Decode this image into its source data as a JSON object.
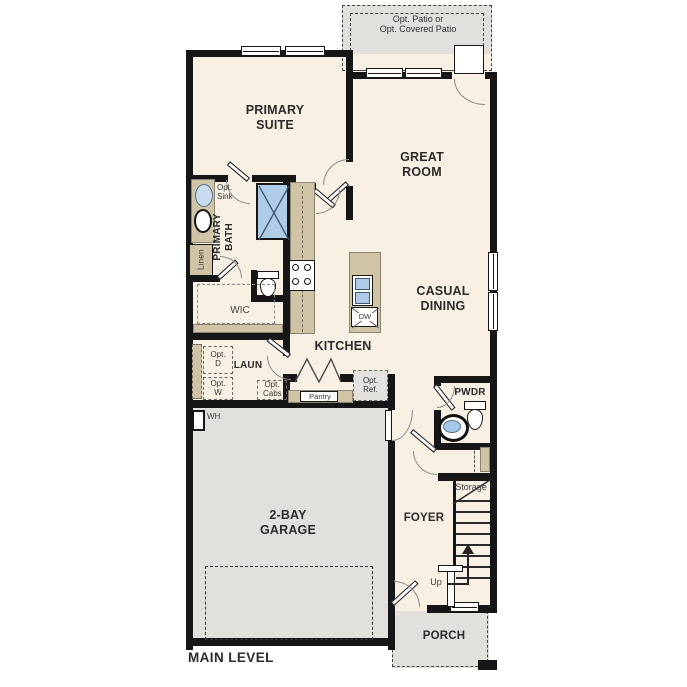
{
  "plan": {
    "level_title": "MAIN LEVEL"
  },
  "rooms": {
    "primary_suite": "PRIMARY SUITE",
    "great_room": "GREAT ROOM",
    "casual_dining": "CASUAL DINING",
    "primary_bath": "PRIMARY BATH",
    "wic": "WIC",
    "linen": "Linen",
    "kitchen": "KITCHEN",
    "laundry": "LAUN",
    "pantry": "Pantry",
    "powder_room": "PWDR",
    "foyer": "FOYER",
    "garage": "2-BAY GARAGE",
    "storage": "Storage",
    "porch": "PORCH"
  },
  "options": {
    "patio_line1": "Opt. Patio or",
    "patio_line2": "Opt. Covered Patio",
    "sink": "Opt. Sink",
    "dryer": "Opt. D",
    "washer": "Opt. W",
    "cabinets": "Opt. Cabs",
    "refrigerator": "Opt. Ref."
  },
  "labels": {
    "water_heater": "WH",
    "dishwasher": "DW",
    "stairs_up": "Up",
    "level_title": "MAIN LEVEL"
  },
  "palette": {
    "wall": "#161616",
    "floor": "#f8f1e3",
    "exterior_concrete": "#e1e0dd",
    "counter": "#d0c4a6",
    "fixture_blue": "#aecbe7"
  }
}
